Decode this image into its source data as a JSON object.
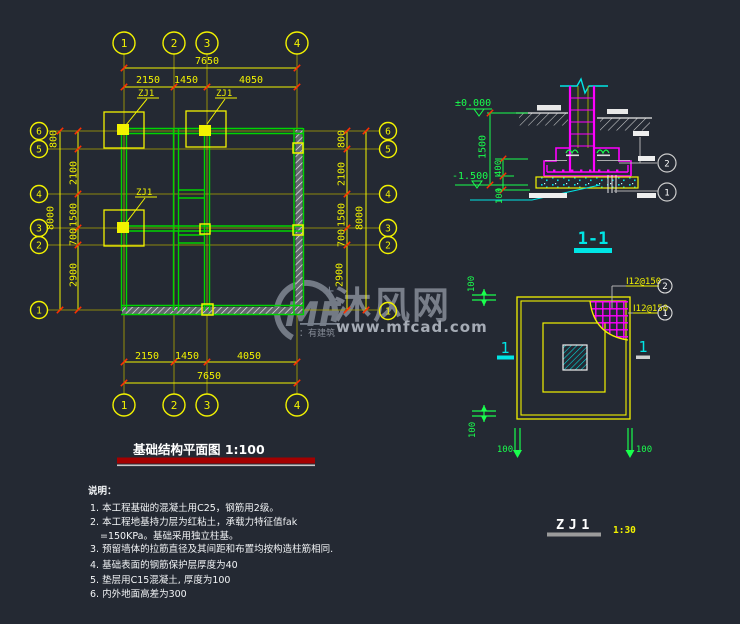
{
  "plan": {
    "title": "基础结构平面图 1:100",
    "axes_top": [
      "1",
      "2",
      "3",
      "4"
    ],
    "axes_bottom": [
      "1",
      "2",
      "3",
      "4"
    ],
    "axes_left": [
      "6",
      "5",
      "4",
      "3",
      "2",
      "1"
    ],
    "axes_right": [
      "6",
      "5",
      "4",
      "3",
      "2",
      "1"
    ],
    "dim_top_total": "7650",
    "dim_top_segs": [
      "2150",
      "1450",
      "4050"
    ],
    "dim_bottom_total": "7650",
    "dim_bottom_segs": [
      "2150",
      "1450",
      "4050"
    ],
    "dim_left_total": "8000",
    "dim_left_segs": [
      "800",
      "2100",
      "1500",
      "700",
      "2900"
    ],
    "dim_right_total": "8000",
    "dim_right_segs": [
      "800",
      "2100",
      "1500",
      "700",
      "2900"
    ],
    "zj_label_1": "ZJ1",
    "zj_label_2": "ZJ1",
    "zj_label_3": "ZJ1"
  },
  "section": {
    "title": "1-1",
    "elev_top": "±0.000",
    "elev_bottom": "-1.500",
    "dim_1500": "1500",
    "dim_400": "400",
    "dim_100": "100",
    "callout_2": "2",
    "callout_1": "1"
  },
  "detail": {
    "name": "ZJ1",
    "scale": "1:30",
    "rebar_top": "Ⅰ12@150",
    "rebar_bottom": "Ⅰ12@150",
    "callout_2": "2",
    "callout_1": "1",
    "dim_top_left": "100",
    "dim_bottom_left": "100",
    "dim_bottom_1": "100",
    "dim_bottom_2": "100",
    "section_mark_left": "1",
    "section_mark_right": "1"
  },
  "notes": {
    "heading": "说明：",
    "items": [
      "1. 本工程基础的混凝土用C25，钢筋用2级。",
      "2. 本工程地基持力层为红粘土，承载力特征值fak",
      "=150KPa。基础采用独立柱基。",
      "3. 预留墙体的拉筋直径及其间距和布置均按构造柱筋相同.",
      "4. 基础表面的钢筋保护层厚度为40",
      "5. 垫层用C15混凝土, 厚度为100",
      "6. 内外地面高差为300"
    ]
  },
  "watermark": {
    "logo": "MF",
    "brand": "沐风网",
    "url": "www.mfcad.com",
    "tagline": "：有建筑"
  },
  "colors": {
    "background": "#242933",
    "yellow": "#f2f200",
    "green": "#00d400",
    "bright_green": "#19ff4d",
    "magenta": "#ff00ff",
    "cyan": "#00e5e5",
    "tick_red": "#ff3000",
    "title_red": "#a40000"
  }
}
